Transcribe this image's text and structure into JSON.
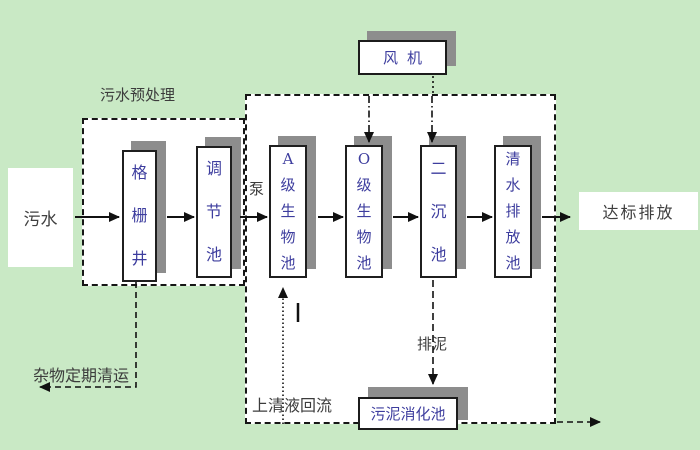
{
  "diagram_title": "污水处理工艺流程图",
  "colors": {
    "background": "#c9e9c5",
    "box_fill": "#ffffff",
    "box_shadow": "#8d8d8d",
    "line": "#161616",
    "tank_text": "#3d3d9e",
    "label_text": "#3c3c3c"
  },
  "labels": {
    "influent": "污水",
    "pretreatment_zone": "污水预处理",
    "pump": "泵",
    "fan": "风机",
    "discharge": "达标排放",
    "debris_removal": "杂物定期清运",
    "supernatant_return": "上清液回流",
    "sludge_discharge": "排泥",
    "excess_sludge_out": "剩余污泥定期外排"
  },
  "tanks": [
    {
      "name": "grid-well",
      "label": "格栅井"
    },
    {
      "name": "regulating-tank",
      "label": "调节池"
    },
    {
      "name": "a-bio-tank",
      "label": "A级生物池"
    },
    {
      "name": "o-bio-tank",
      "label": "O级生物池"
    },
    {
      "name": "secondary-sedimentation-tank",
      "label": "二沉池"
    },
    {
      "name": "clear-water-discharge-tank",
      "label": "清水排放池"
    }
  ],
  "digester": {
    "label": "污泥消化池"
  },
  "flow": [
    "污水 → 格栅井 → 调节池 → (泵) → A级生物池 → O级生物池 → 二沉池 → 清水排放池 → 达标排放",
    "风机 → O级生物池 / 二沉池 (曝气)",
    "格栅井 → 杂物定期清运",
    "A级生物池 ← 上清液回流 ← 污泥消化池区",
    "二沉池 → 排泥 → 污泥消化池 → 剩余污泥定期外排"
  ]
}
